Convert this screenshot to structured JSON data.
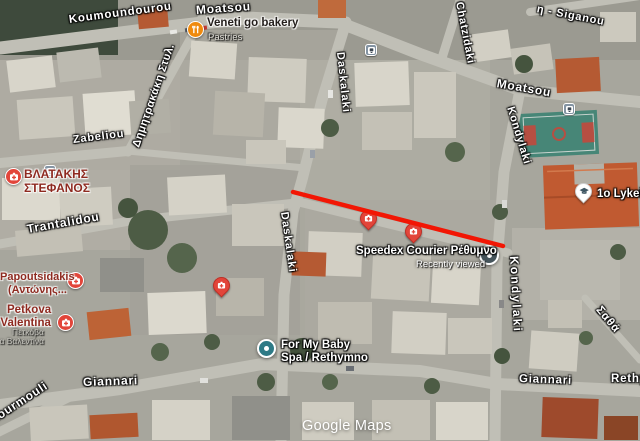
{
  "attribution": "Google Maps",
  "streets": {
    "koumoundourou": "Koumoundourou",
    "moatsou_top": "Moatsou",
    "moatsou_right": "Moatsou",
    "dimitrakaki": "Δημητρακάκη Στυλ.",
    "zabeliou": "Zabeliou",
    "trantalidou": "Trantalidou",
    "daskalaki_top": "Daskalaki",
    "daskalaki_mid": "Daskalaki",
    "chatzidaki": "Chatzidaki",
    "siganou_partial": "η - Siganou",
    "kondylaki_top": "Kondylaki",
    "kondylaki_bottom": "Kondylaki",
    "giannari_left": "Giannari",
    "giannari_right": "Giannari",
    "kourmouli": "Kourmouli",
    "satha": "Σαθά",
    "rethymno_partial": "Rethymno"
  },
  "pois": {
    "veneti": {
      "name": "Veneti go bakery",
      "category": "Pastries"
    },
    "vlastakis": {
      "line1": "ΒΛΑΤΑΚΗΣ",
      "line2": "ΣΤΕΦΑΝΟΣ"
    },
    "papoutsidakis": {
      "line1": "Papoutsidakis",
      "line2": "(Αντώνης..."
    },
    "petkova": {
      "line1": "Petkova",
      "line2": "ta Valentina",
      "alt1": "Πετκόβα",
      "alt2": "ντα Βαλεντίνα"
    },
    "speedex": {
      "name": "Speedex Courier Ρέθυμνο",
      "status": "Recently viewed"
    },
    "for_my_baby": {
      "line1": "For My Baby",
      "line2": "Spa / Rethymno"
    },
    "lykeio": {
      "name": "1o Lykeio"
    }
  },
  "annotation": {
    "stroke": "#f21604"
  },
  "colors": {
    "poi_red": "#e2453a",
    "poi_orange": "#ef8a0e",
    "recent_slate": "#46555c",
    "visited_teal": "#2e7a86",
    "transit_blue": "#8494a3",
    "school_glyph": "#3e5663"
  }
}
